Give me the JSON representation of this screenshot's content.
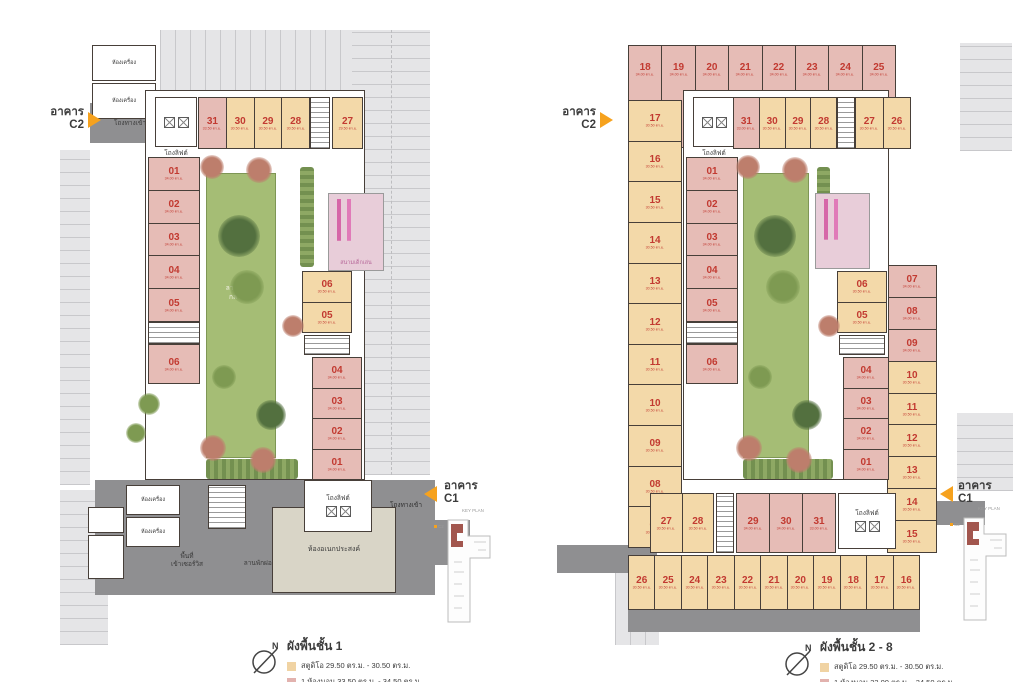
{
  "shared": {
    "north_label": "N",
    "key_plan_label": "KEY PLAN",
    "kp_c2": "C2",
    "kp_c1": "C1",
    "building_c2": {
      "line1": "อาคาร",
      "line2": "C2"
    },
    "building_c1": {
      "line1": "อาคาร",
      "line2": "C1"
    },
    "colors": {
      "studio": "#f3d9a9",
      "onebed": "#e6bcb6",
      "unit_number_red": "#c23a31",
      "accent_orange": "#F6A21E",
      "road_gray": "#8f8f91",
      "parking_gray": "#e5e5e7",
      "lawn_green": "#a5bd75",
      "multipurpose_beige": "#d9d5c7"
    }
  },
  "left_plan": {
    "title": "ผังพื้นชั้น 1",
    "legend": [
      {
        "type": "studio",
        "label": "สตูดิโอ 29.50 ตร.ม. - 30.50 ตร.ม."
      },
      {
        "type": "onebed",
        "label": "1 ห้องนอน 33.50 ตร.ม. - 34.50 ตร.ม."
      }
    ],
    "labels": {
      "entrance_hall_top": "โถงทางเข้า",
      "lift_hall_top": "โถงลิฟต์",
      "machine_room": "ห้องเครื่อง",
      "lift_hall_bottom": "โถงลิฟต์",
      "entrance_hall_bottom": "โถงทางเข้า",
      "multipurpose_room": "ห้องอเนกประสงค์",
      "service_area_line1": "พื้นที่",
      "service_area_line2": "เข้าเซอร์วิส",
      "relax_court": "ลานพักผ่อน",
      "lawn_line1": "ลานพักผ่อน",
      "lawn_line2": "กลางแจ้ง",
      "playground": "สนามเด็กเล่น"
    },
    "units": {
      "top_a": [
        {
          "no": "31",
          "t": "onebed",
          "a": "33.50 ตร.ม."
        },
        {
          "no": "30",
          "t": "studio",
          "a": "30.50 ตร.ม."
        },
        {
          "no": "29",
          "t": "studio",
          "a": "30.50 ตร.ม."
        },
        {
          "no": "28",
          "t": "studio",
          "a": "30.50 ตร.ม."
        }
      ],
      "top_b": [
        {
          "no": "27",
          "t": "studio",
          "a": "29.50 ตร.ม."
        }
      ],
      "west_upper": [
        {
          "no": "01",
          "t": "onebed",
          "a": "34.00 ตร.ม."
        },
        {
          "no": "02",
          "t": "onebed",
          "a": "34.00 ตร.ม."
        },
        {
          "no": "03",
          "t": "onebed",
          "a": "34.00 ตร.ม."
        },
        {
          "no": "04",
          "t": "onebed",
          "a": "34.00 ตร.ม."
        },
        {
          "no": "05",
          "t": "onebed",
          "a": "34.00 ตร.ม."
        }
      ],
      "west_lower": [
        {
          "no": "06",
          "t": "onebed",
          "a": "34.00 ตร.ม."
        }
      ],
      "east_upper": [
        {
          "no": "06",
          "t": "studio",
          "a": "30.50 ตร.ม."
        },
        {
          "no": "05",
          "t": "studio",
          "a": "30.50 ตร.ม."
        }
      ],
      "east_lower": [
        {
          "no": "04",
          "t": "onebed",
          "a": "34.00 ตร.ม."
        },
        {
          "no": "03",
          "t": "onebed",
          "a": "34.00 ตร.ม."
        },
        {
          "no": "02",
          "t": "onebed",
          "a": "34.00 ตร.ม."
        },
        {
          "no": "01",
          "t": "onebed",
          "a": "34.00 ตร.ม."
        }
      ]
    }
  },
  "right_plan": {
    "title": "ผังพื้นชั้น 2 - 8",
    "legend": [
      {
        "type": "studio",
        "label": "สตูดิโอ 29.50 ตร.ม. - 30.50 ตร.ม."
      },
      {
        "type": "onebed",
        "label": "1 ห้องนอน 33.00 ตร.ม. - 34.50 ตร.ม."
      }
    ],
    "labels": {
      "lift_hall_top": "โถงลิฟต์",
      "lift_hall_bottom": "โถงลิฟต์"
    },
    "units": {
      "outer_top": [
        {
          "no": "18",
          "t": "onebed",
          "a": "34.00 ตร.ม."
        },
        {
          "no": "19",
          "t": "onebed",
          "a": "34.00 ตร.ม."
        },
        {
          "no": "20",
          "t": "onebed",
          "a": "34.00 ตร.ม."
        },
        {
          "no": "21",
          "t": "onebed",
          "a": "34.00 ตร.ม."
        },
        {
          "no": "22",
          "t": "onebed",
          "a": "34.00 ตร.ม."
        },
        {
          "no": "23",
          "t": "onebed",
          "a": "34.00 ตร.ม."
        },
        {
          "no": "24",
          "t": "onebed",
          "a": "34.00 ตร.ม."
        },
        {
          "no": "25",
          "t": "onebed",
          "a": "34.00 ตร.ม."
        }
      ],
      "outer_west": [
        {
          "no": "17",
          "t": "studio",
          "a": "30.50 ตร.ม."
        },
        {
          "no": "16",
          "t": "studio",
          "a": "30.50 ตร.ม."
        },
        {
          "no": "15",
          "t": "studio",
          "a": "30.50 ตร.ม."
        },
        {
          "no": "14",
          "t": "studio",
          "a": "30.50 ตร.ม."
        },
        {
          "no": "13",
          "t": "studio",
          "a": "30.50 ตร.ม."
        },
        {
          "no": "12",
          "t": "studio",
          "a": "30.50 ตร.ม."
        },
        {
          "no": "11",
          "t": "studio",
          "a": "30.50 ตร.ม."
        },
        {
          "no": "10",
          "t": "studio",
          "a": "30.50 ตร.ม."
        },
        {
          "no": "09",
          "t": "studio",
          "a": "30.50 ตร.ม."
        },
        {
          "no": "08",
          "t": "studio",
          "a": "30.50 ตร.ม."
        },
        {
          "no": "07",
          "t": "studio",
          "a": "30.50 ตร.ม."
        }
      ],
      "top_a": [
        {
          "no": "31",
          "t": "onebed",
          "a": "33.00 ตร.ม."
        },
        {
          "no": "30",
          "t": "studio",
          "a": "30.50 ตร.ม."
        },
        {
          "no": "29",
          "t": "studio",
          "a": "30.50 ตร.ม."
        },
        {
          "no": "28",
          "t": "studio",
          "a": "30.50 ตร.ม."
        }
      ],
      "top_b": [
        {
          "no": "27",
          "t": "studio",
          "a": "30.50 ตร.ม."
        },
        {
          "no": "26",
          "t": "studio",
          "a": "30.50 ตร.ม."
        }
      ],
      "west_upper": [
        {
          "no": "01",
          "t": "onebed",
          "a": "34.00 ตร.ม."
        },
        {
          "no": "02",
          "t": "onebed",
          "a": "34.00 ตร.ม."
        },
        {
          "no": "03",
          "t": "onebed",
          "a": "34.00 ตร.ม."
        },
        {
          "no": "04",
          "t": "onebed",
          "a": "34.00 ตร.ม."
        },
        {
          "no": "05",
          "t": "onebed",
          "a": "34.00 ตร.ม."
        }
      ],
      "west_lower": [
        {
          "no": "06",
          "t": "onebed",
          "a": "34.00 ตร.ม."
        }
      ],
      "east_upper": [
        {
          "no": "06",
          "t": "studio",
          "a": "30.50 ตร.ม."
        },
        {
          "no": "05",
          "t": "studio",
          "a": "30.50 ตร.ม."
        }
      ],
      "east_lower": [
        {
          "no": "04",
          "t": "onebed",
          "a": "34.00 ตร.ม."
        },
        {
          "no": "03",
          "t": "onebed",
          "a": "34.00 ตร.ม."
        },
        {
          "no": "02",
          "t": "onebed",
          "a": "34.00 ตร.ม."
        },
        {
          "no": "01",
          "t": "onebed",
          "a": "34.00 ตร.ม."
        }
      ],
      "outer_east": [
        {
          "no": "07",
          "t": "onebed",
          "a": "34.00 ตร.ม."
        },
        {
          "no": "08",
          "t": "onebed",
          "a": "34.00 ตร.ม."
        },
        {
          "no": "09",
          "t": "onebed",
          "a": "34.00 ตร.ม."
        },
        {
          "no": "10",
          "t": "studio",
          "a": "30.50 ตร.ม."
        },
        {
          "no": "11",
          "t": "studio",
          "a": "30.50 ตร.ม."
        },
        {
          "no": "12",
          "t": "studio",
          "a": "30.50 ตร.ม."
        },
        {
          "no": "13",
          "t": "studio",
          "a": "30.50 ตร.ม."
        },
        {
          "no": "14",
          "t": "studio",
          "a": "30.50 ตร.ม."
        },
        {
          "no": "15",
          "t": "studio",
          "a": "30.50 ตร.ม."
        }
      ],
      "bottom_pair": [
        {
          "no": "27",
          "t": "studio",
          "a": "30.50 ตร.ม."
        },
        {
          "no": "28",
          "t": "studio",
          "a": "30.50 ตร.ม."
        }
      ],
      "bottom_mid": [
        {
          "no": "29",
          "t": "onebed",
          "a": "34.00 ตร.ม."
        },
        {
          "no": "30",
          "t": "onebed",
          "a": "34.00 ตร.ม."
        },
        {
          "no": "31",
          "t": "onebed",
          "a": "33.00 ตร.ม."
        }
      ],
      "outer_bottom": [
        {
          "no": "26",
          "t": "studio",
          "a": "30.50 ตร.ม."
        },
        {
          "no": "25",
          "t": "studio",
          "a": "30.50 ตร.ม."
        },
        {
          "no": "24",
          "t": "studio",
          "a": "30.50 ตร.ม."
        },
        {
          "no": "23",
          "t": "studio",
          "a": "30.50 ตร.ม."
        },
        {
          "no": "22",
          "t": "studio",
          "a": "30.50 ตร.ม."
        },
        {
          "no": "21",
          "t": "studio",
          "a": "30.50 ตร.ม."
        },
        {
          "no": "20",
          "t": "studio",
          "a": "30.50 ตร.ม."
        },
        {
          "no": "19",
          "t": "studio",
          "a": "30.50 ตร.ม."
        },
        {
          "no": "18",
          "t": "studio",
          "a": "30.50 ตร.ม."
        },
        {
          "no": "17",
          "t": "studio",
          "a": "30.50 ตร.ม."
        },
        {
          "no": "16",
          "t": "studio",
          "a": "30.50 ตร.ม."
        }
      ]
    }
  }
}
